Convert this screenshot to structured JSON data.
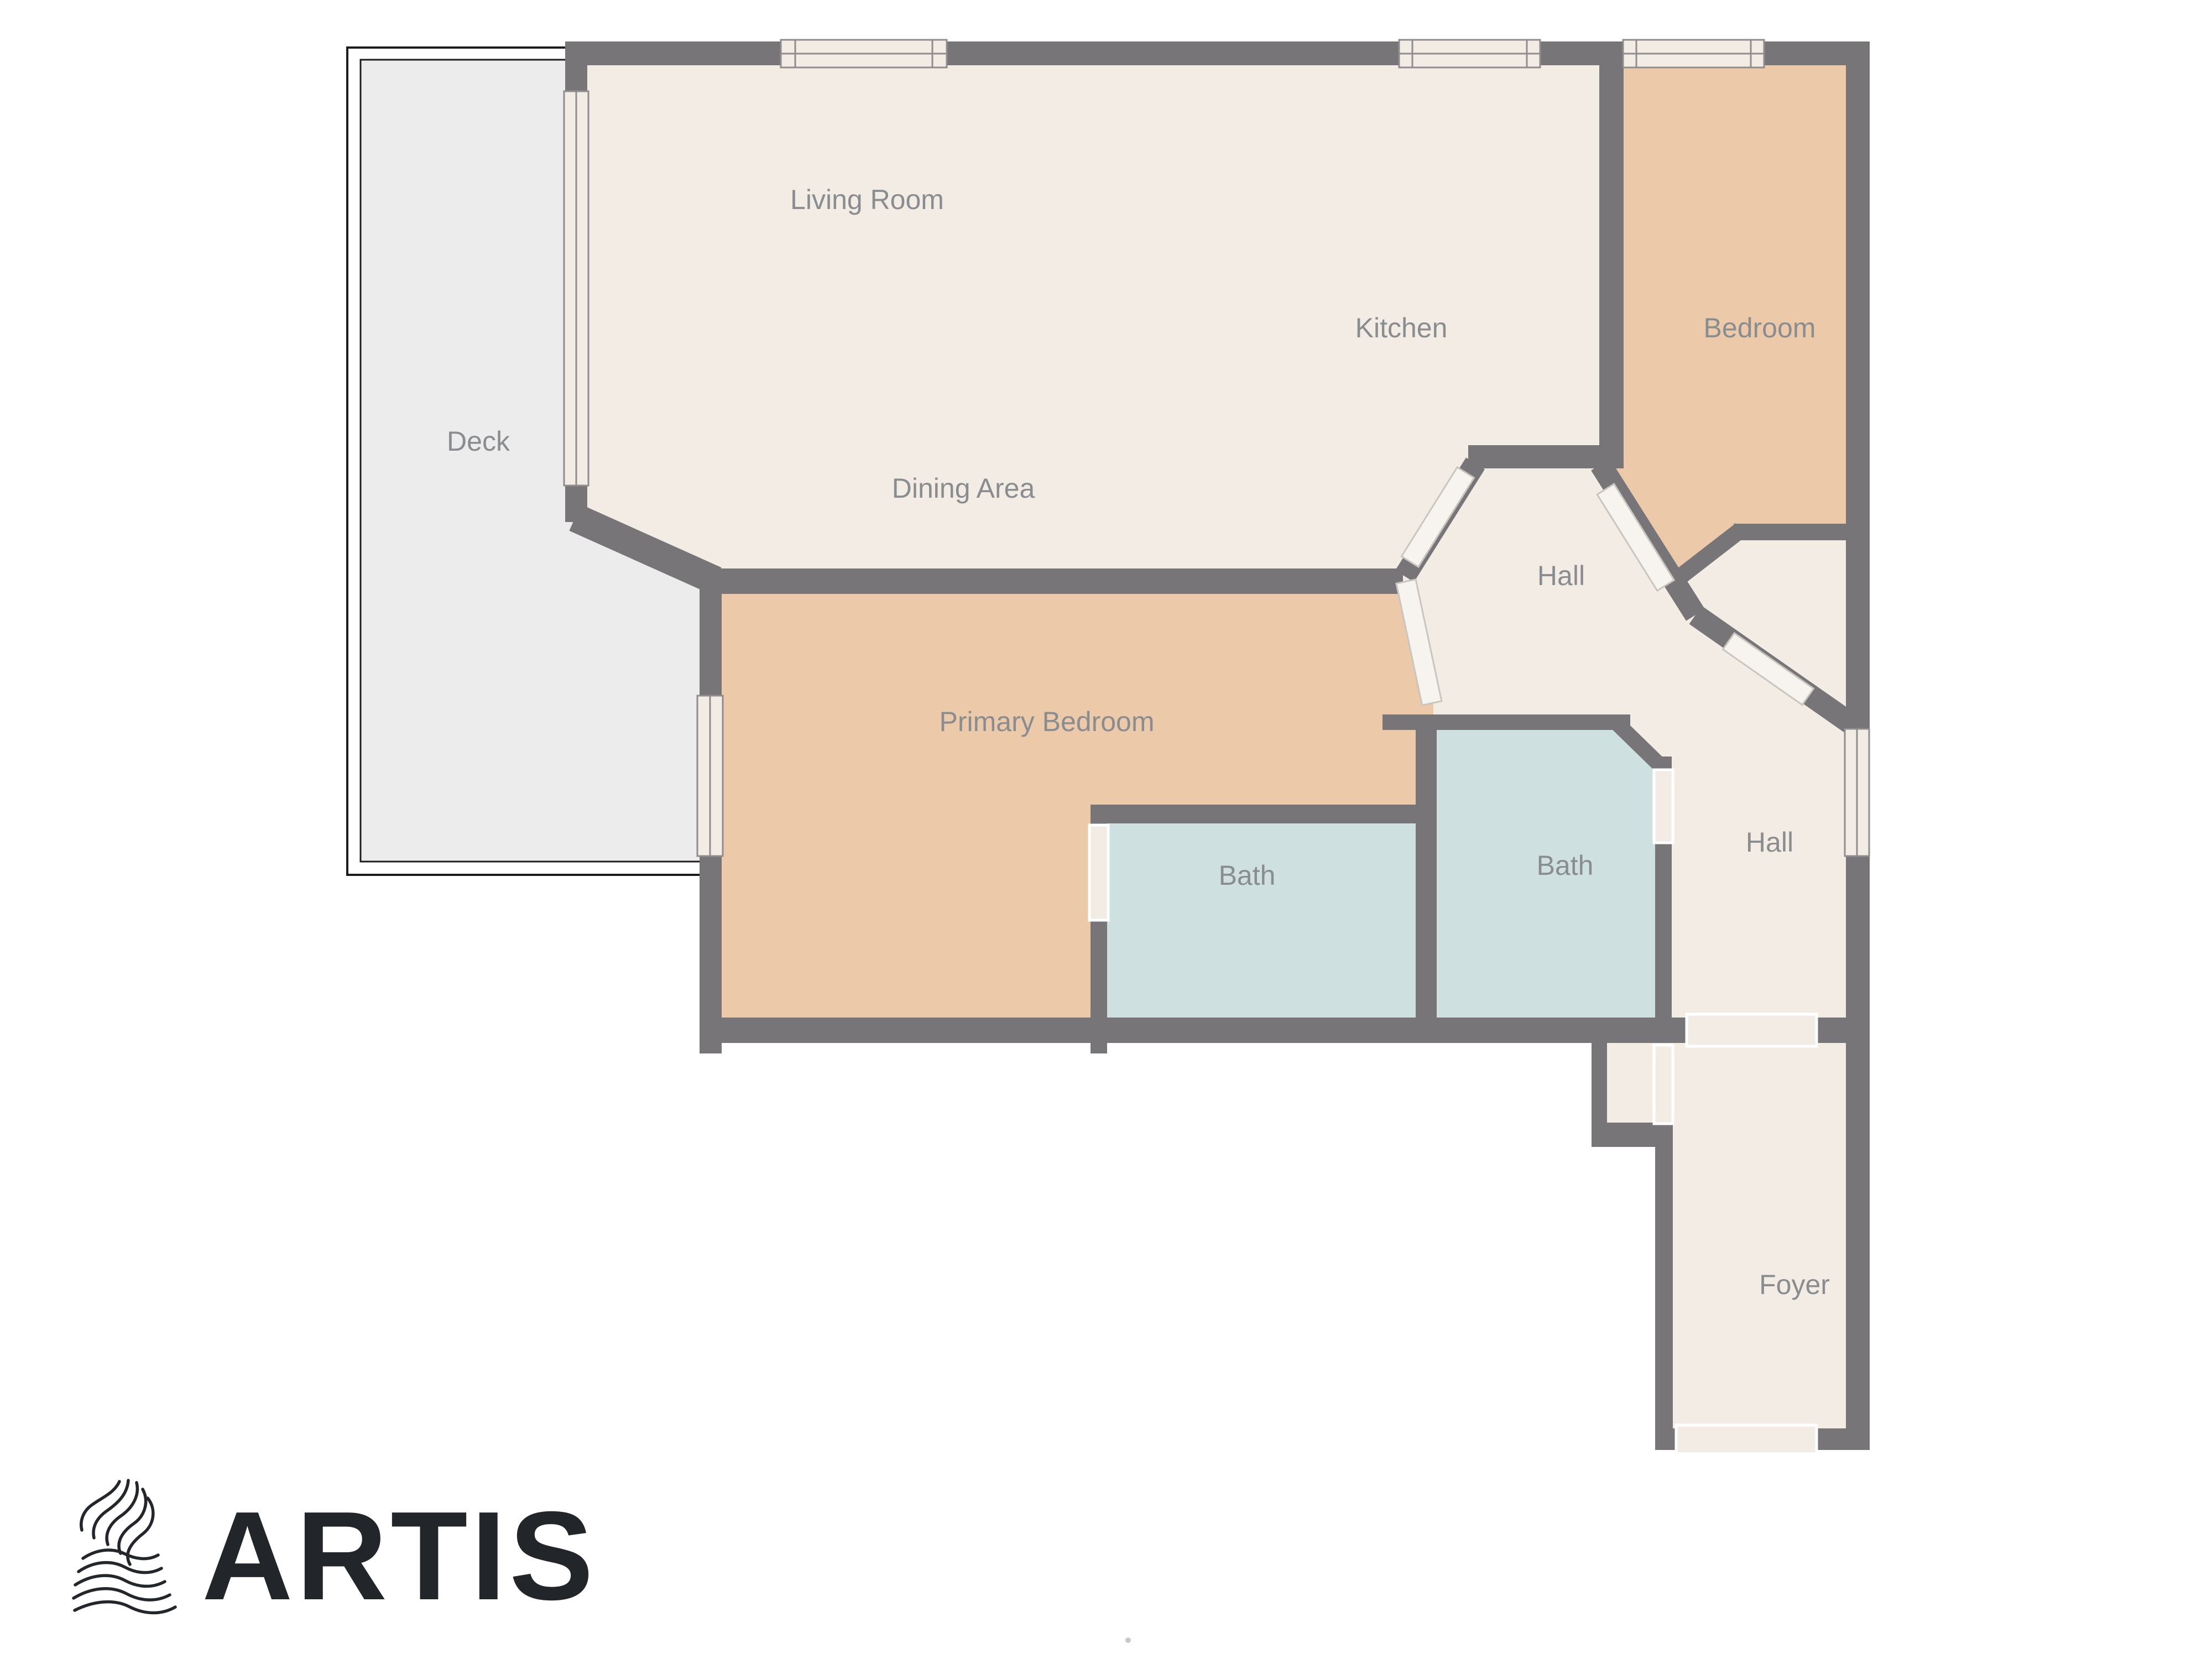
{
  "floorplan": {
    "rooms": [
      {
        "id": "deck",
        "label": "Deck"
      },
      {
        "id": "living-room",
        "label": "Living Room"
      },
      {
        "id": "kitchen",
        "label": "Kitchen"
      },
      {
        "id": "dining-area",
        "label": "Dining Area"
      },
      {
        "id": "bedroom",
        "label": "Bedroom"
      },
      {
        "id": "hall-center",
        "label": "Hall"
      },
      {
        "id": "primary-bedroom",
        "label": "Primary Bedroom"
      },
      {
        "id": "bath-left",
        "label": "Bath"
      },
      {
        "id": "bath-right",
        "label": "Bath"
      },
      {
        "id": "hall-right",
        "label": "Hall"
      },
      {
        "id": "foyer",
        "label": "Foyer"
      }
    ],
    "colors": {
      "wall": "#777577",
      "floor_main": "#f2ece5",
      "floor_bedroom": "#ecc9a8",
      "floor_bath": "#cfe0e0",
      "deck": "#ececec",
      "deck_outline": "#1d1d1b",
      "opening": "#ffffff",
      "label_text": "#8a8d8f"
    }
  },
  "branding": {
    "logo_text": "ARTIS",
    "logo_color": "#22252a"
  }
}
